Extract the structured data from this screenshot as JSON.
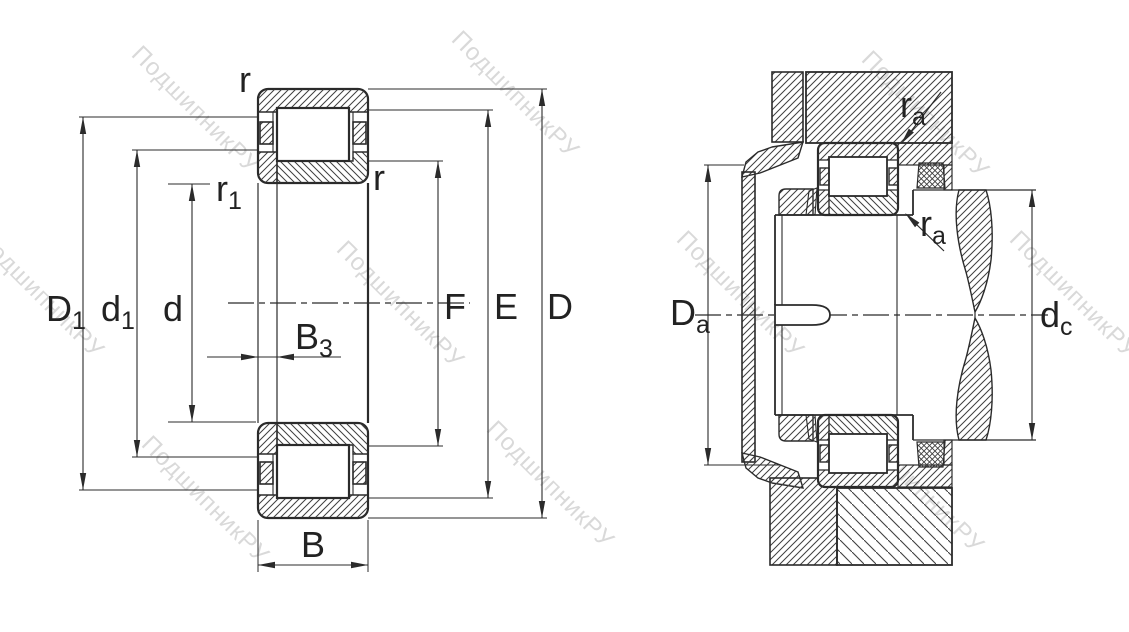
{
  "colors": {
    "bg": "#ffffff",
    "line": "#2b2b2b",
    "hatch": "#3f3f3f",
    "text": "#222222",
    "watermark": "#c3c3c3"
  },
  "watermark": {
    "text": "ПодшипникРУ"
  },
  "left_diagram": {
    "name": "cylindrical-roller-bearing-cross-section",
    "labels": {
      "r_top": {
        "base": "r",
        "sub": ""
      },
      "r1": {
        "base": "r",
        "sub": "1"
      },
      "r_inner": {
        "base": "r",
        "sub": ""
      },
      "D1": {
        "base": "D",
        "sub": "1"
      },
      "d1": {
        "base": "d",
        "sub": "1"
      },
      "d": {
        "base": "d",
        "sub": ""
      },
      "B3": {
        "base": "B",
        "sub": "3"
      },
      "B": {
        "base": "B",
        "sub": ""
      },
      "F": {
        "base": "F",
        "sub": ""
      },
      "E": {
        "base": "E",
        "sub": ""
      },
      "D": {
        "base": "D",
        "sub": ""
      }
    }
  },
  "right_diagram": {
    "name": "mounted-bearing-abutment-dimensions",
    "labels": {
      "ra_upper": {
        "base": "r",
        "sub": "a"
      },
      "ra_lower": {
        "base": "r",
        "sub": "a"
      },
      "Da": {
        "base": "D",
        "sub": "a"
      },
      "dc": {
        "base": "d",
        "sub": "c"
      }
    }
  }
}
